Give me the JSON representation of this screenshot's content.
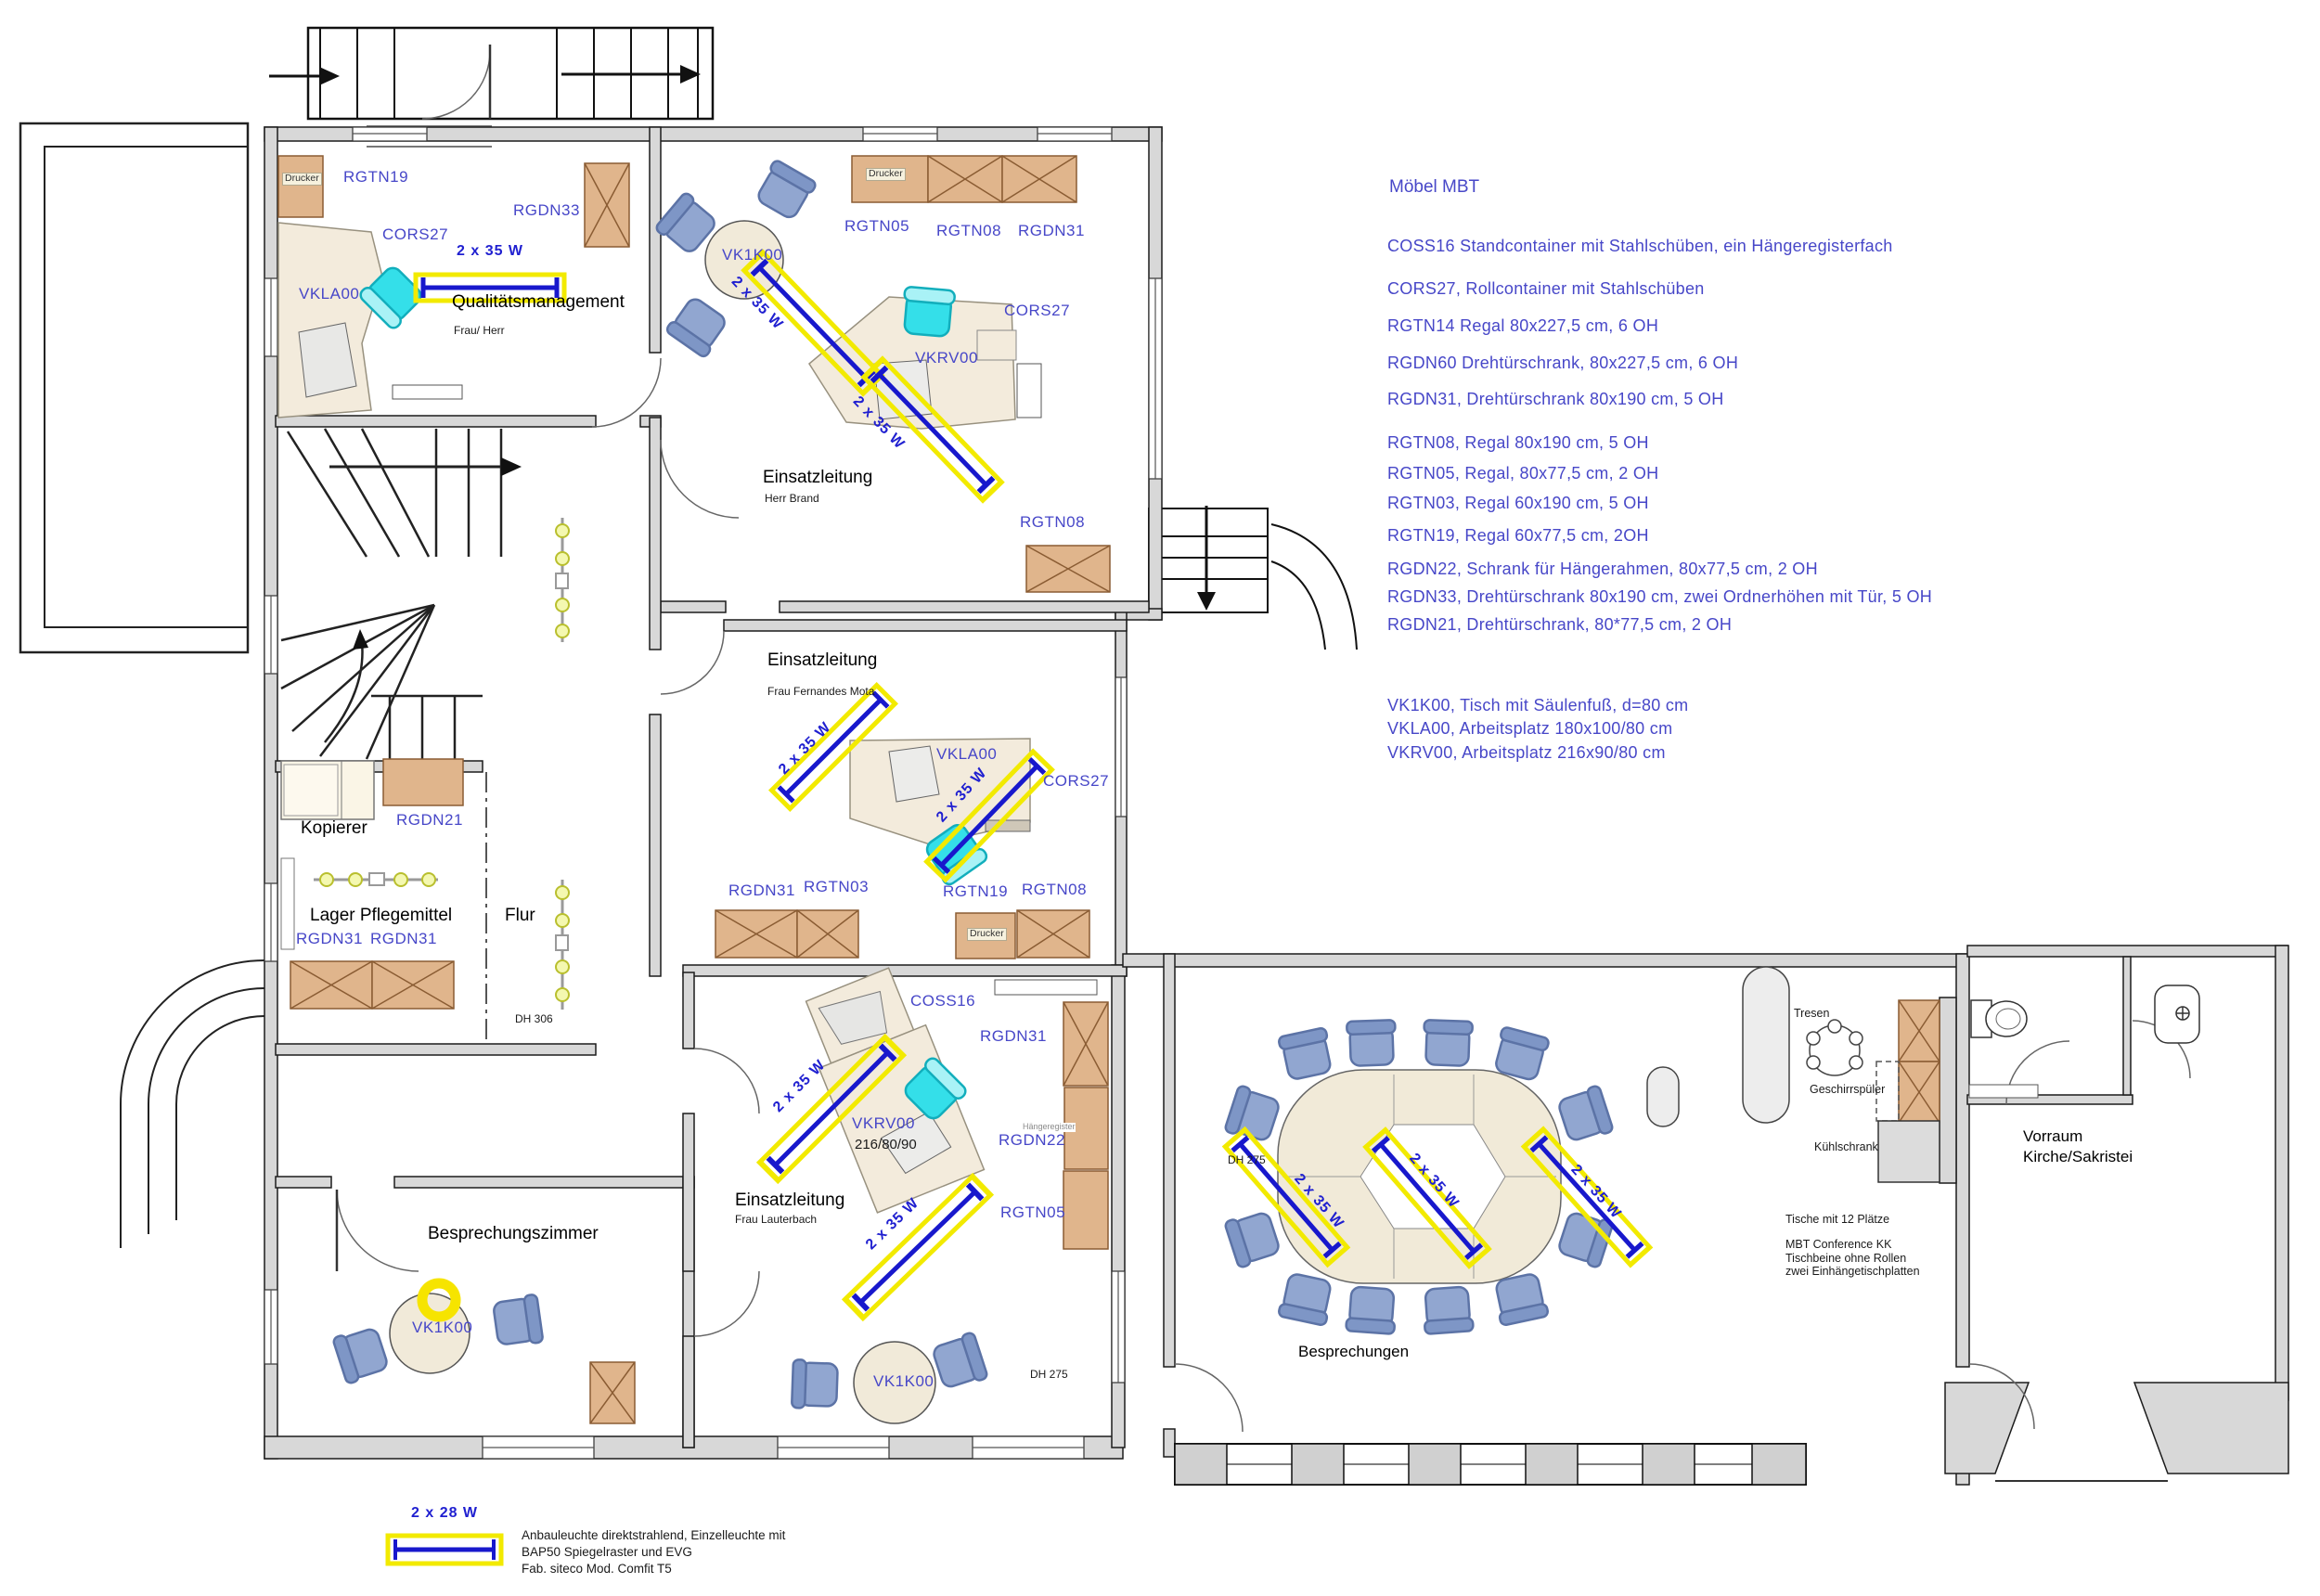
{
  "legend": {
    "title": "Möbel MBT",
    "items": [
      "COSS16  Standcontainer mit Stahlschüben, ein Hängeregisterfach",
      "CORS27, Rollcontainer mit Stahlschüben",
      "RGTN14 Regal 80x227,5 cm, 6 OH",
      "RGDN60 Drehtürschrank, 80x227,5 cm, 6 OH",
      "RGDN31, Drehtürschrank 80x190 cm, 5 OH",
      "RGTN08, Regal 80x190 cm, 5 OH",
      "RGTN05, Regal, 80x77,5 cm, 2 OH",
      "RGTN03, Regal 60x190 cm, 5 OH",
      "RGTN19, Regal 60x77,5 cm, 2OH",
      "RGDN22, Schrank für Hängerahmen, 80x77,5 cm, 2 OH",
      "RGDN33, Drehtürschrank 80x190 cm, zwei Ordnerhöhen mit Tür, 5 OH",
      "RGDN21, Drehtürschrank, 80*77,5 cm, 2 OH",
      "VK1K00, Tisch mit Säulenfuß, d=80 cm",
      "VKLA00, Arbeitsplatz 180x100/80 cm",
      "VKRV00, Arbeitsplatz 216x90/80 cm"
    ]
  },
  "rooms": {
    "qualitaetsmanagement": {
      "name": "Qualitätsmanagement",
      "occupant": "Frau/ Herr"
    },
    "einsatzleitung_brand": {
      "name": "Einsatzleitung",
      "occupant": "Herr Brand"
    },
    "einsatzleitung_mota": {
      "name": "Einsatzleitung",
      "occupant": "Frau Fernandes Mota"
    },
    "einsatzleitung_lauterbach": {
      "name": "Einsatzleitung",
      "occupant": "Frau Lauterbach"
    },
    "kopierer": {
      "name": "Kopierer"
    },
    "lager": {
      "name": "Lager Pflegemittel"
    },
    "flur": {
      "name": "Flur"
    },
    "besprechungszimmer": {
      "name": "Besprechungszimmer"
    },
    "besprechungen": {
      "name": "Besprechungen"
    },
    "vorraum": {
      "name": "Vorraum",
      "name2": "Kirche/Sakristei"
    }
  },
  "codes": {
    "drucker": "Drucker",
    "rgtn19": "RGTN19",
    "rgdn33": "RGDN33",
    "cors27": "CORS27",
    "vkla00": "VKLA00",
    "rgtn05": "RGTN05",
    "rgtn08": "RGTN08",
    "rgdn31": "RGDN31",
    "vk1k00": "VK1K00",
    "vkrv00": "VKRV00",
    "rgtn03": "RGTN03",
    "rgdn21": "RGDN21",
    "rgdn22": "RGDN22",
    "coss16": "COSS16",
    "haengeregister": "Hängeregister",
    "vkrv_dims": "216/80/90"
  },
  "lights": {
    "w35": "2 x 35 W",
    "w28": "2 x 28 W",
    "note1": "Anbauleuchte direktstrahlend, Einzelleuchte mit",
    "note2": "BAP50 Spiegelraster und EVG",
    "note3": "Fab. siteco Mod. Comfit T5"
  },
  "annotations": {
    "dh306": "DH 306",
    "dh275": "DH 275",
    "tresen": "Tresen",
    "geschirrspueler": "Geschirrspüler",
    "kuehlschrank": "Kühlschrank",
    "tische": "Tische mit 12 Plätze",
    "conference1": "MBT Conference KK",
    "conference2": "Tischbeine ohne Rollen",
    "conference3": "zwei Einhängetischplatten"
  },
  "colors": {
    "code_blue": "#4747c8",
    "lamp_yellow": "#f2ea00",
    "lamp_blue": "#1818cc",
    "wall_gray": "#d8d8d8",
    "cabinet_tan": "#e0b58c",
    "chair_blue": "#91a6d0",
    "chair_cyan": "#34dfe9",
    "desk_beige": "#f3ebdc"
  }
}
